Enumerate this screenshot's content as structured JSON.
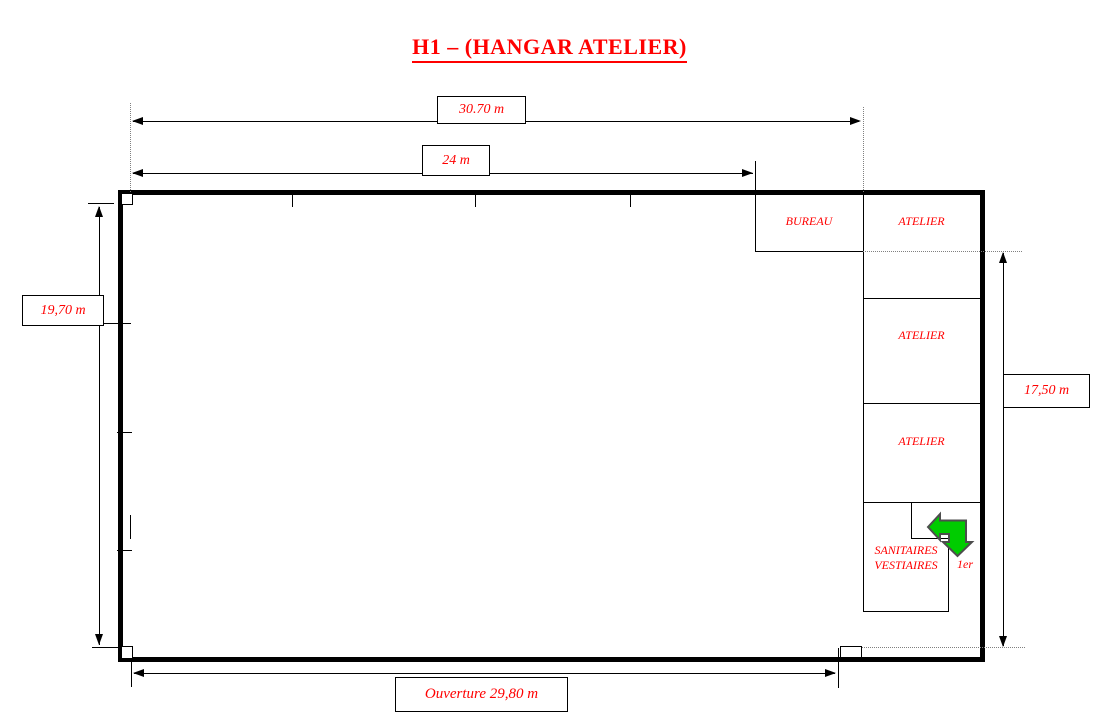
{
  "title": {
    "text": "H1 – (HANGAR ATELIER)"
  },
  "colors": {
    "accent_red": "#FF0000",
    "wall_black": "#000000",
    "guide_gray": "#808080",
    "arrow_green": "#00CC00",
    "arrow_outline": "#4D4D4D"
  },
  "dimensions": {
    "top_outer": {
      "label": "30.70 m"
    },
    "top_inner": {
      "label": "24 m"
    },
    "left": {
      "label": "19,70 m"
    },
    "right": {
      "label": "17,50 m"
    },
    "bottom": {
      "label": "Ouverture 29,80 m"
    }
  },
  "rooms": {
    "bureau": {
      "label": "BUREAU"
    },
    "ateliers": [
      {
        "label": "ATELIER"
      },
      {
        "label": "ATELIER"
      },
      {
        "label": "ATELIER"
      }
    ],
    "sanitaires": {
      "label_line1": "SANITAIRES",
      "label_line2": "VESTIAIRES"
    },
    "floor_note": {
      "label": "1er"
    }
  },
  "icons": {
    "stairs_arrow": "elbow-arrow-left-down"
  }
}
